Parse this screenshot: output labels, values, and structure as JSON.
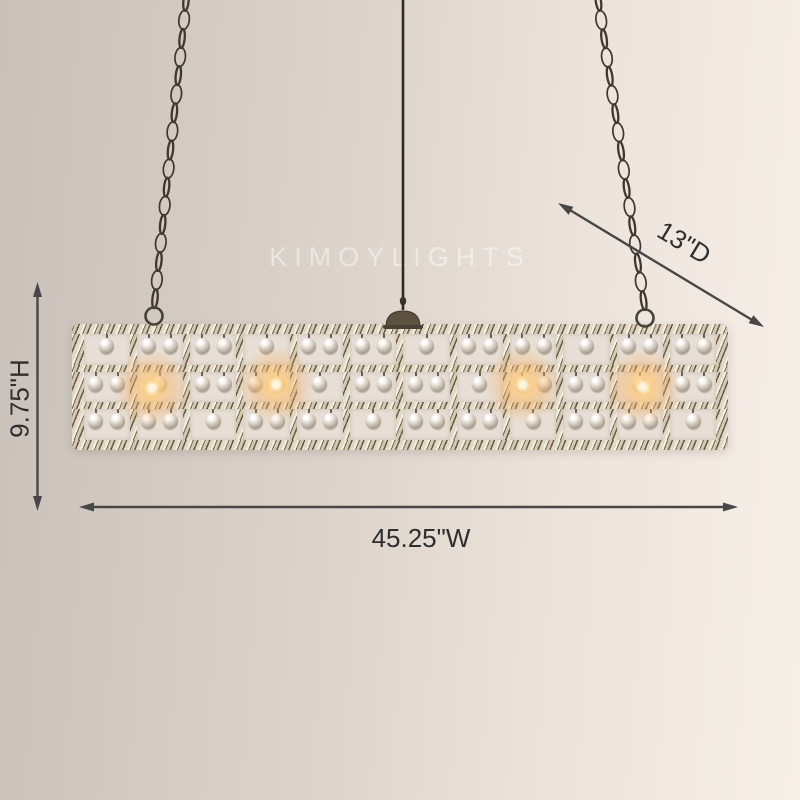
{
  "watermark": {
    "text": "KIMOYLIGHTS"
  },
  "dimension_labels": {
    "height": "9.75\"H",
    "width": "45.25\"W",
    "depth": "13\"D"
  },
  "style": {
    "arrow_color": "#474747",
    "label_color": "#2e2e2e",
    "background_left": "#c9c1b9",
    "background_right": "#f6efe8",
    "metal_base": "#a99b82",
    "cell_background": "#e7dfd5",
    "glow_color": "#ffcb7a"
  },
  "chandelier": {
    "rows": 3,
    "columns": 12,
    "lit_bulb_count": 4
  }
}
